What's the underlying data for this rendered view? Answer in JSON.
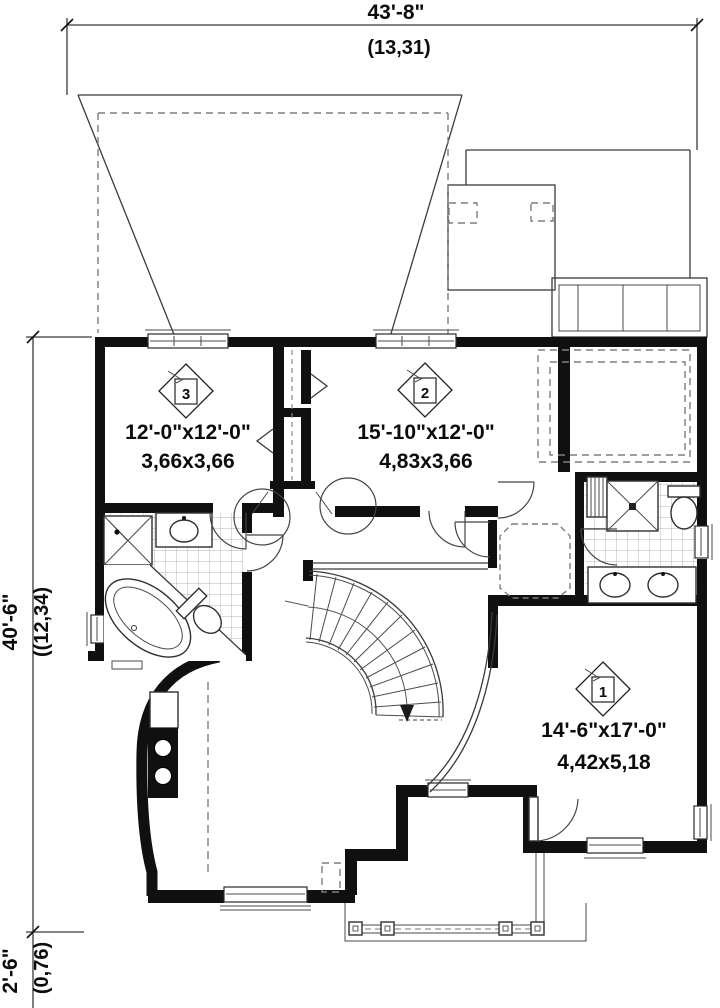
{
  "plan": {
    "dimensions": {
      "top": {
        "imperial": "43'-8\"",
        "metric": "(13,31)"
      },
      "left": {
        "imperial": "40'-6\"",
        "metric": "((12,34)"
      },
      "bottom_left": {
        "imperial": "2'-6\"",
        "metric": "(0,76)"
      }
    },
    "rooms": [
      {
        "marker": "3",
        "imperial": "12'-0\"x12'-0\"",
        "metric": "3,66x3,66"
      },
      {
        "marker": "2",
        "imperial": "15'-10\"x12'-0\"",
        "metric": "4,83x3,66"
      },
      {
        "marker": "1",
        "imperial": "14'-6\"x17'-0\"",
        "metric": "4,42x5,18"
      }
    ],
    "colors": {
      "wall": "#101010",
      "line": "#3a3a3a",
      "dash": "#7d7d7d",
      "background": "#ffffff"
    }
  }
}
